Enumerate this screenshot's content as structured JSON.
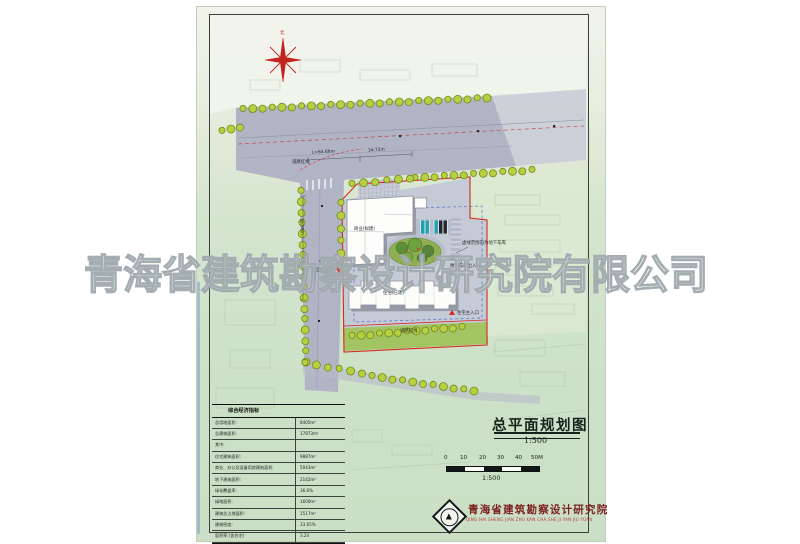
{
  "document": {
    "watermark": "青海省建筑勘察设计研究院有限公司",
    "title": "总平面规划图",
    "title_scale": "1:500",
    "scalebar": {
      "labels": [
        "0",
        "10",
        "20",
        "30",
        "40",
        "50M"
      ],
      "caption": "1:500"
    },
    "publisher": {
      "name": "青海省建筑勘察设计研究院",
      "pinyin": "QING HAI SHENG JIAN ZHU KAN CHA SHE JI YAN JIU YUAN",
      "logo_glyph": "▲"
    }
  },
  "plan": {
    "compass_label": "北",
    "labels": {
      "road_redline_top": "道路红线",
      "dim_length": "L=64.66m",
      "dim_top": "34.72m",
      "dim_left_road": "30.98m",
      "building_proposed": "商业(拟建)",
      "building_existing": "住宅(已建)",
      "entry_commercial": "商业主入口",
      "entry_residential": "住宅主入口",
      "garage_note": "虚线范围内为地下车库",
      "garage_entry": "地下车库出入口",
      "road_redline_bottom": "道路红线"
    },
    "colors": {
      "site_boundary_red": "#d42a1e",
      "road_grey": "#b0b4c4",
      "tree_green": "#b8cf3f",
      "garden_green": "#8fae52",
      "garage_dashed_blue": "#4a66cc",
      "sheet_green": "#cde1c8"
    }
  },
  "table": {
    "header": "综合经济指标",
    "rows": [
      {
        "label": "总用地面积:",
        "value": "8405m²"
      },
      {
        "label": "总建筑面积:",
        "value": "17873m²"
      },
      {
        "label": "其中:",
        "value": ""
      },
      {
        "label": "住宅建筑面积:",
        "value": "9887m²"
      },
      {
        "label": "商业、办公及设备用房建筑面积:",
        "value": "5043m²"
      },
      {
        "label": "地下建筑面积:",
        "value": "2142m²"
      },
      {
        "label": "绿化覆盖率:",
        "value": "36.6%"
      },
      {
        "label": "绿地面积:",
        "value": "1600m²"
      },
      {
        "label": "建筑总占地面积:",
        "value": "1517m²"
      },
      {
        "label": "建筑密度:",
        "value": "33.65%"
      },
      {
        "label": "容积率:(含住宅)",
        "value": "3.24"
      }
    ]
  }
}
